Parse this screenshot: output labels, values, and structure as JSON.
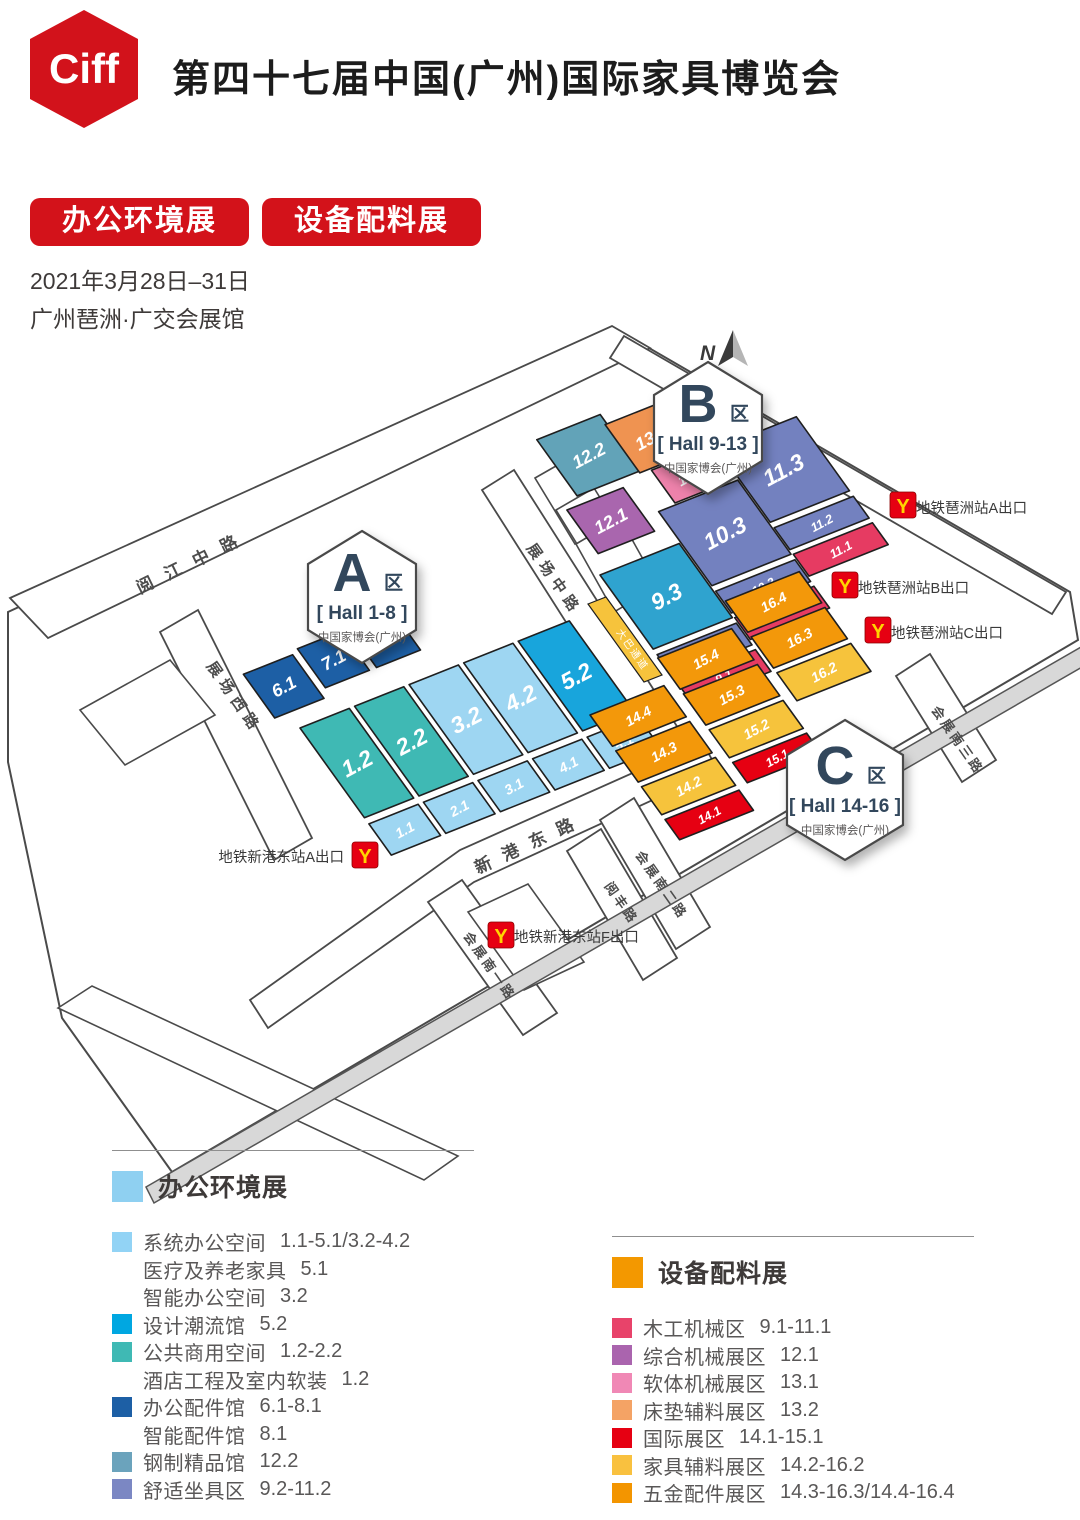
{
  "header": {
    "logo_text": "Ciff",
    "title": "第四十七届中国(广州)国际家具博览会",
    "badges": [
      "办公环境展",
      "设备配料展"
    ],
    "date": "2021年3月28日–31日",
    "venue": "广州琶洲·广交会展馆"
  },
  "colors": {
    "brand_red": "#d3121a",
    "logo_red": "#d2121b",
    "badge_text": "#31475c",
    "system_office": "#9ed6f2",
    "design_trend": "#18a5dc",
    "public_commercial": "#3fb9b4",
    "office_accessories": "#1d5fa5",
    "steel_boutique": "#62a3b8",
    "comfort_seating": "#7381bf",
    "hall_9_3_cyan": "#2fa3cf",
    "woodworking": "#e63b62",
    "general_machinery": "#a966ae",
    "soft_machinery": "#ee82ab",
    "mattress_materials": "#ef9351",
    "international": "#e60012",
    "furniture_materials": "#f6c33c",
    "hardware": "#f3980a",
    "road_fill": "#ffffff",
    "road_stroke": "#4a4a4a",
    "expressway_fill": "#d8d8d8",
    "metro_red": "#e60012",
    "metro_yellow": "#ffd400"
  },
  "map": {
    "compass": {
      "label": "N",
      "x": 700,
      "y": 360,
      "needle_x": 733,
      "needle_y": 330
    },
    "grid": {
      "u": [
        0.88,
        -0.35
      ],
      "v": [
        0.56,
        0.78
      ],
      "origins": {
        "A": [
          300,
          728
        ],
        "B": [
          600,
          575
        ],
        "C": [
          590,
          715
        ]
      }
    },
    "site_outline": "8,612 618,330 1070,592 1078,640 172,1172 62,1018 8,762",
    "expressway": {
      "points": "146,1187 1081,647 1089,663 154,1203"
    },
    "blocks": [
      {
        "id": "block-west",
        "points": "80,710 170,660 215,715 125,765"
      },
      {
        "id": "building-1",
        "points": "535,478 570,458 610,524 575,544"
      },
      {
        "id": "building-2",
        "points": "556,510 594,488 636,556 598,578"
      },
      {
        "id": "building-3",
        "points": "576,544 620,518 658,586 614,612"
      },
      {
        "id": "block-south",
        "points": "468,912 528,884 584,962 524,990"
      },
      {
        "id": "block-southwest-band",
        "points": "58,1008 92,986 458,1156 424,1180"
      }
    ],
    "roads": [
      {
        "id": "yuejiang-middle-road",
        "points": "10,598 612,326 650,348 48,638",
        "label": {
          "text": "阅江中路",
          "x": 140,
          "y": 594,
          "rotate": -26,
          "size": 17,
          "spacing": 14
        }
      },
      {
        "id": "zhanchang-west-road",
        "points": "160,632 198,610 312,838 274,860",
        "label": {
          "text": "展场西路",
          "x": 206,
          "y": 666,
          "rotate": 55,
          "size": 15,
          "spacing": 6
        }
      },
      {
        "id": "zhanchang-middle-road",
        "points": "482,490 514,470 692,750 660,770",
        "label": {
          "text": "展场中路",
          "x": 526,
          "y": 548,
          "rotate": 55,
          "size": 15,
          "spacing": 6
        }
      },
      {
        "id": "xingang-east-road",
        "points": "250,1000 460,850 702,742 718,770 474,882 268,1028",
        "label": {
          "text": "新港东路",
          "x": 478,
          "y": 874,
          "rotate": -25,
          "size": 17,
          "spacing": 13
        }
      },
      {
        "id": "huizhan-south-1-road",
        "points": "428,902 462,880 557,1013 523,1035",
        "label": {
          "text": "会展南一路",
          "x": 463,
          "y": 936,
          "rotate": 55,
          "size": 13,
          "spacing": 3
        }
      },
      {
        "id": "yuefeng-road",
        "points": "567,851 601,829 677,958 643,980",
        "label": {
          "text": "阅丰路",
          "x": 604,
          "y": 886,
          "rotate": 55,
          "size": 13,
          "spacing": 3
        }
      },
      {
        "id": "huizhan-south-2-road",
        "points": "600,820 634,798 710,927 676,949",
        "label": {
          "text": "会展南二路",
          "x": 635,
          "y": 855,
          "rotate": 55,
          "size": 13,
          "spacing": 3
        }
      },
      {
        "id": "huizhan-south-3-road",
        "points": "896,676 930,654 996,760 962,782",
        "label": {
          "text": "会展南三路",
          "x": 931,
          "y": 710,
          "rotate": 55,
          "size": 13,
          "spacing": 3
        }
      },
      {
        "id": "northeast-road",
        "points": "624,336 1066,592 1052,614 610,358",
        "label": null
      }
    ],
    "walkway": {
      "points": "588,604 606,597 662,675 644,682",
      "label": {
        "text": "大巴通道",
        "x": 616,
        "y": 632,
        "rotate": 55,
        "size": 10,
        "spacing": 2
      }
    },
    "halls": [
      {
        "id": "6.1",
        "zone": "A",
        "x": -16,
        "y": -76,
        "w": 56,
        "h": 56,
        "color": "office_accessories"
      },
      {
        "id": "7.1",
        "zone": "A",
        "x": 48,
        "y": -80,
        "w": 50,
        "h": 50,
        "color": "office_accessories"
      },
      {
        "id": "8.1",
        "zone": "A",
        "x": 106,
        "y": -80,
        "w": 50,
        "h": 50,
        "color": "office_accessories"
      },
      {
        "id": "1.2",
        "zone": "A",
        "x": 0,
        "y": 0,
        "w": 56,
        "h": 115,
        "color": "public_commercial"
      },
      {
        "id": "2.2",
        "zone": "A",
        "x": 62,
        "y": 0,
        "w": 56,
        "h": 115,
        "color": "public_commercial"
      },
      {
        "id": "3.2",
        "zone": "A",
        "x": 124,
        "y": 0,
        "w": 56,
        "h": 115,
        "color": "system_office"
      },
      {
        "id": "4.2",
        "zone": "A",
        "x": 186,
        "y": 0,
        "w": 56,
        "h": 115,
        "color": "system_office"
      },
      {
        "id": "5.2",
        "zone": "A",
        "x": 248,
        "y": 0,
        "w": 58,
        "h": 115,
        "color": "design_trend"
      },
      {
        "id": "1.1",
        "zone": "A",
        "x": 0,
        "y": 123,
        "w": 56,
        "h": 40,
        "color": "system_office"
      },
      {
        "id": "2.1",
        "zone": "A",
        "x": 62,
        "y": 123,
        "w": 56,
        "h": 40,
        "color": "system_office"
      },
      {
        "id": "3.1",
        "zone": "A",
        "x": 124,
        "y": 123,
        "w": 56,
        "h": 40,
        "color": "system_office"
      },
      {
        "id": "4.1",
        "zone": "A",
        "x": 186,
        "y": 123,
        "w": 56,
        "h": 40,
        "color": "system_office"
      },
      {
        "id": "5.1",
        "zone": "A",
        "x": 248,
        "y": 123,
        "w": 58,
        "h": 40,
        "color": "system_office"
      },
      {
        "id": "12.2",
        "zone": "B",
        "x": 30,
        "y": -160,
        "w": 72,
        "h": 72,
        "color": "steel_boutique"
      },
      {
        "id": "13.2",
        "zone": "B",
        "x": 100,
        "y": -148,
        "w": 66,
        "h": 62,
        "color": "mattress_materials"
      },
      {
        "id": "12.1",
        "zone": "B",
        "x": 12,
        "y": -78,
        "w": 64,
        "h": 56,
        "color": "general_machinery"
      },
      {
        "id": "13.1",
        "zone": "B",
        "x": 112,
        "y": -84,
        "w": 62,
        "h": 42,
        "color": "soft_machinery"
      },
      {
        "id": "11.3",
        "zone": "B",
        "x": 184,
        "y": -80,
        "w": 90,
        "h": 95,
        "color": "comfort_seating"
      },
      {
        "id": "11.2",
        "zone": "B",
        "x": 184,
        "y": 22,
        "w": 90,
        "h": 28,
        "color": "comfort_seating"
      },
      {
        "id": "11.1",
        "zone": "B",
        "x": 184,
        "y": 56,
        "w": 90,
        "h": 28,
        "color": "woodworking"
      },
      {
        "id": "10.3",
        "zone": "B",
        "x": 92,
        "y": -40,
        "w": 90,
        "h": 95,
        "color": "comfort_seating"
      },
      {
        "id": "10.2",
        "zone": "B",
        "x": 92,
        "y": 62,
        "w": 90,
        "h": 28,
        "color": "comfort_seating"
      },
      {
        "id": "10.1",
        "zone": "B",
        "x": 92,
        "y": 96,
        "w": 90,
        "h": 28,
        "color": "woodworking"
      },
      {
        "id": "9.3",
        "zone": "B",
        "x": 0,
        "y": 0,
        "w": 90,
        "h": 95,
        "color": "hall_9_3_cyan"
      },
      {
        "id": "9.2",
        "zone": "B",
        "x": 0,
        "y": 102,
        "w": 90,
        "h": 28,
        "color": "comfort_seating"
      },
      {
        "id": "9.1",
        "zone": "B",
        "x": 0,
        "y": 136,
        "w": 90,
        "h": 28,
        "color": "woodworking"
      },
      {
        "id": "16.4",
        "zone": "C",
        "x": 192,
        "y": -60,
        "w": 84,
        "h": 40,
        "color": "hardware"
      },
      {
        "id": "16.3",
        "zone": "C",
        "x": 192,
        "y": -14,
        "w": 84,
        "h": 40,
        "color": "hardware"
      },
      {
        "id": "16.2",
        "zone": "C",
        "x": 192,
        "y": 32,
        "w": 84,
        "h": 36,
        "color": "furniture_materials"
      },
      {
        "id": "15.4",
        "zone": "C",
        "x": 96,
        "y": -30,
        "w": 84,
        "h": 40,
        "color": "hardware"
      },
      {
        "id": "15.3",
        "zone": "C",
        "x": 96,
        "y": 16,
        "w": 84,
        "h": 40,
        "color": "hardware"
      },
      {
        "id": "15.2",
        "zone": "C",
        "x": 96,
        "y": 62,
        "w": 84,
        "h": 36,
        "color": "furniture_materials"
      },
      {
        "id": "15.1",
        "zone": "C",
        "x": 96,
        "y": 104,
        "w": 84,
        "h": 26,
        "color": "international"
      },
      {
        "id": "14.4",
        "zone": "C",
        "x": 0,
        "y": 0,
        "w": 84,
        "h": 40,
        "color": "hardware"
      },
      {
        "id": "14.3",
        "zone": "C",
        "x": 0,
        "y": 46,
        "w": 84,
        "h": 40,
        "color": "hardware"
      },
      {
        "id": "14.2",
        "zone": "C",
        "x": 0,
        "y": 92,
        "w": 84,
        "h": 36,
        "color": "furniture_materials"
      },
      {
        "id": "14.1",
        "zone": "C",
        "x": 0,
        "y": 134,
        "w": 84,
        "h": 26,
        "color": "international"
      }
    ],
    "zone_badges": [
      {
        "id": "A",
        "letter": "A",
        "suffix": "区",
        "range": "[ Hall 1-8 ]",
        "subtitle": "中国家博会(广州)",
        "cx": 362,
        "cy": 597,
        "rx": 54,
        "ry": 66
      },
      {
        "id": "B",
        "letter": "B",
        "suffix": "区",
        "range": "[ Hall 9-13 ]",
        "subtitle": "中国家博会(广州)",
        "cx": 708,
        "cy": 428,
        "rx": 54,
        "ry": 66
      },
      {
        "id": "C",
        "letter": "C",
        "suffix": "区",
        "range": "[ Hall 14-16 ]",
        "subtitle": "中国家博会(广州)",
        "cx": 845,
        "cy": 790,
        "rx": 58,
        "ry": 70
      }
    ],
    "metro_exits": [
      {
        "id": "pazhou-a",
        "label": "地铁琶洲站A出口",
        "icon_x": 890,
        "icon_y": 492,
        "label_x": 916,
        "label_y": 513,
        "anchor": "start"
      },
      {
        "id": "pazhou-b",
        "label": "地铁琶洲站B出口",
        "icon_x": 832,
        "icon_y": 572,
        "label_x": 858,
        "label_y": 593,
        "anchor": "start"
      },
      {
        "id": "pazhou-c",
        "label": "地铁琶洲站C出口",
        "icon_x": 865,
        "icon_y": 617,
        "label_x": 891,
        "label_y": 638,
        "anchor": "start"
      },
      {
        "id": "xingangdong-a",
        "label": "地铁新港东站A出口",
        "icon_x": 352,
        "icon_y": 842,
        "label_x": 344,
        "label_y": 862,
        "anchor": "end"
      },
      {
        "id": "xingangdong-f",
        "label": "地铁新港东站F出口",
        "icon_x": 488,
        "icon_y": 922,
        "label_x": 514,
        "label_y": 942,
        "anchor": "start"
      }
    ]
  },
  "legend_left": {
    "title": "办公环境展",
    "title_color": "#8fd0f1",
    "items": [
      {
        "color": "#92d3f5",
        "name": "系统办公空间",
        "range": "1.1-5.1/3.2-4.2"
      },
      {
        "color": null,
        "name": "医疗及养老家具",
        "range": "5.1"
      },
      {
        "color": null,
        "name": "智能办公空间",
        "range": "3.2"
      },
      {
        "color": "#00a7e1",
        "name": "设计潮流馆",
        "range": "5.2"
      },
      {
        "color": "#3fb9b4",
        "name": "公共商用空间",
        "range": "1.2-2.2"
      },
      {
        "color": null,
        "name": "酒店工程及室内软装",
        "range": "1.2"
      },
      {
        "color": "#1d5fa5",
        "name": "办公配件馆",
        "range": "6.1-8.1"
      },
      {
        "color": null,
        "name": "智能配件馆",
        "range": "8.1"
      },
      {
        "color": "#6ba3bc",
        "name": "钢制精品馆",
        "range": "12.2"
      },
      {
        "color": "#7b87c3",
        "name": "舒适坐具区",
        "range": "9.2-11.2"
      }
    ]
  },
  "legend_right": {
    "title": "设备配料展",
    "title_color": "#f39800",
    "items": [
      {
        "color": "#e8436a",
        "name": "木工机械区",
        "range": "9.1-11.1"
      },
      {
        "color": "#aa64ae",
        "name": "综合机械展区",
        "range": "12.1"
      },
      {
        "color": "#f088b5",
        "name": "软体机械展区",
        "range": "13.1"
      },
      {
        "color": "#f4a365",
        "name": "床垫辅料展区",
        "range": "13.2"
      },
      {
        "color": "#e60012",
        "name": "国际展区",
        "range": "14.1-15.1"
      },
      {
        "color": "#f9c13f",
        "name": "家具辅料展区",
        "range": "14.2-16.2"
      },
      {
        "color": "#f39500",
        "name": "五金配件展区",
        "range": "14.3-16.3/14.4-16.4"
      }
    ]
  }
}
